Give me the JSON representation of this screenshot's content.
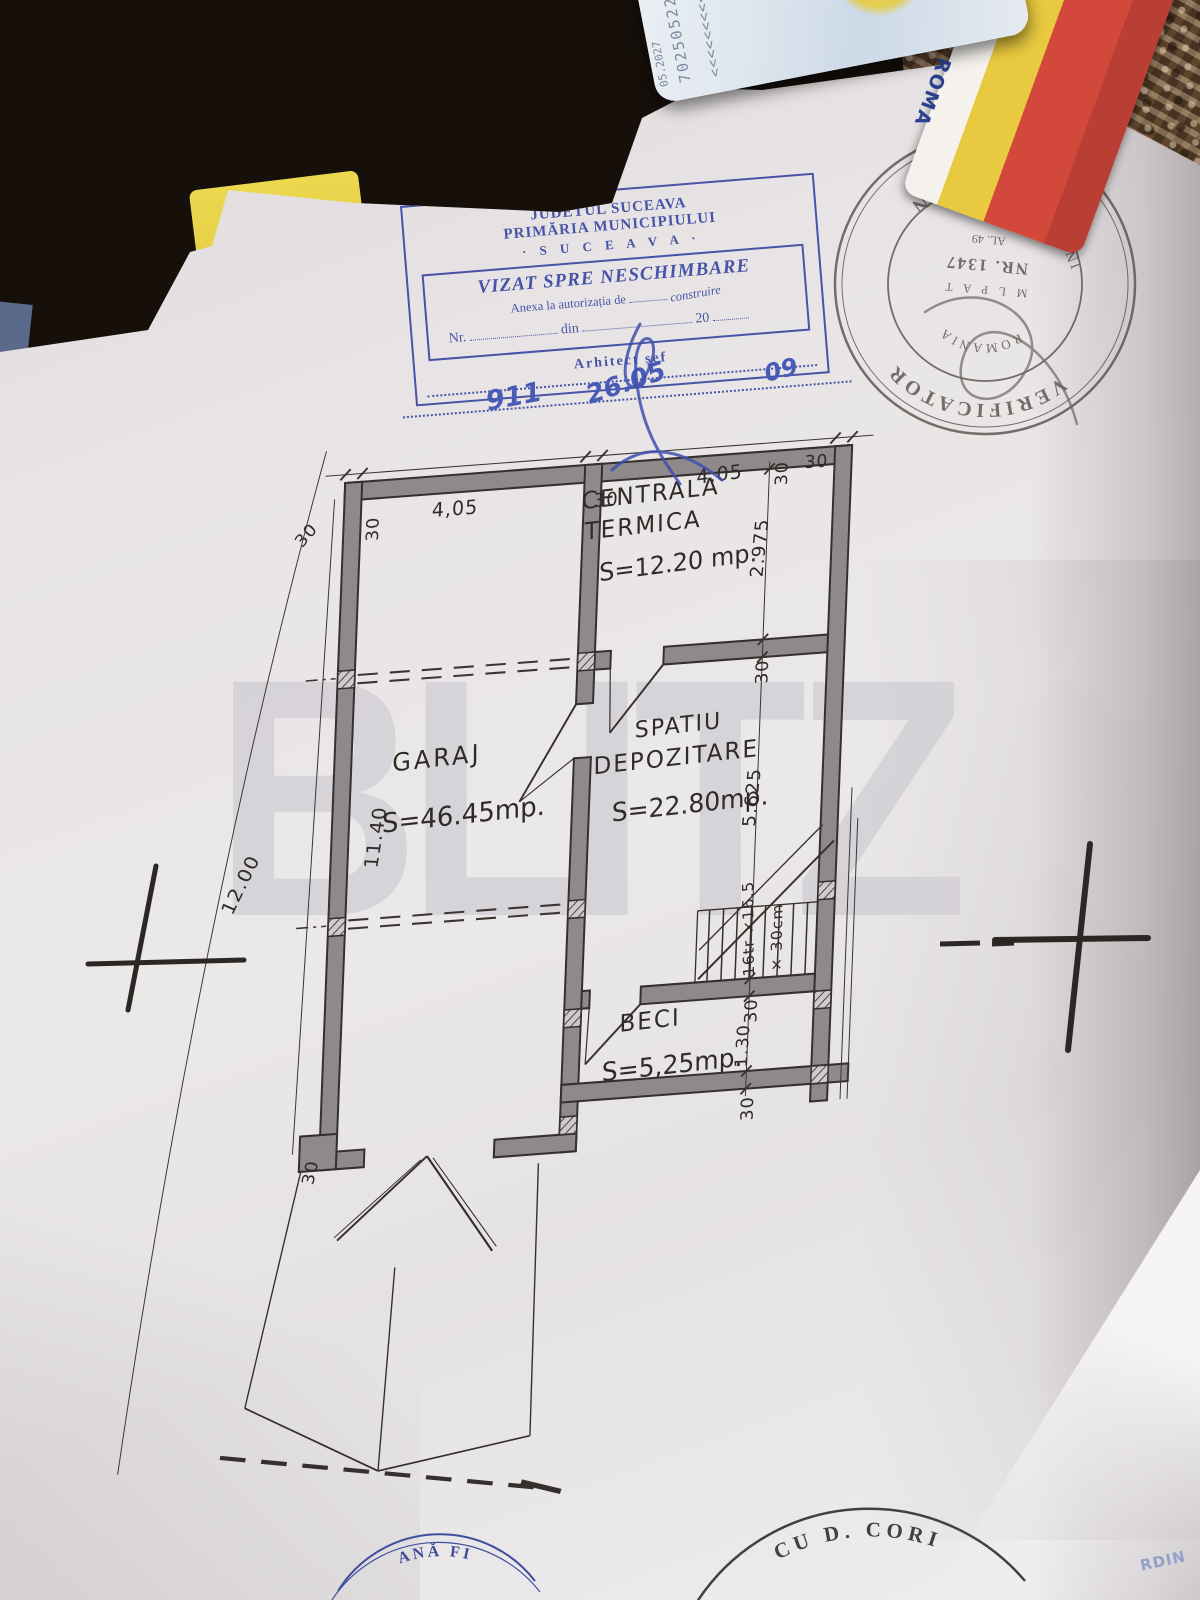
{
  "watermark": "BLITZ",
  "approval_stamp": {
    "county": "JUDETUL SUCEAVA",
    "municipality": "PRIMĂRIA MUNICIPIULUI",
    "city": "· S U C E A V A ·",
    "title": "VIZAT SPRE NESCHIMBARE",
    "annex_prefix": "Anexa la autorizația de",
    "annex_value": "construire",
    "nr_label": "Nr.",
    "din_label": "din",
    "year_prefix": "20",
    "signer": "Arhitect șef",
    "hand_nr": "911",
    "hand_date": "26.05",
    "hand_year": "09"
  },
  "verifier_stamp": {
    "ring_top": "VERIFICATOR",
    "ring_side1": "INGINER",
    "ring_side2": "PROIECTE",
    "ring_bottom": "GHITA D. IOAN",
    "country": "ROMANIA",
    "org": "M L P A T",
    "number": "NR. 1347",
    "al": "AL. 49"
  },
  "plan": {
    "rooms": {
      "centrala": {
        "name1": "CENTRALA",
        "name2": "TERMICA",
        "area": "S=12.20 mp."
      },
      "garaj": {
        "name": "GARAJ",
        "area": "S=46.45mp."
      },
      "depozitare": {
        "name1": "SPATIU",
        "name2": "DEPOZITARE",
        "area": "S=22.80mp."
      },
      "beci": {
        "name": "BECI",
        "area": "S=5,25mp."
      }
    },
    "stair_note1": "16tr ×16.5",
    "stair_note2": "× 30cm",
    "dims": {
      "wall": "30",
      "top_left_span": "4,05",
      "top_right_span": "4.05",
      "h_centrala": "2.975",
      "h_depozitare": "5.625",
      "h_beci": "1.30",
      "left_inner": "11.40",
      "left_outer": "12.00"
    }
  },
  "bottom_stamps": {
    "left": "ANĂ FI",
    "center": "CU D. CORI",
    "right": "RDIN"
  },
  "id_card": {
    "country": "ROMA",
    "serial": "7025052204",
    "mrz": "<<<<<<<<<<<<",
    "date": "05.2027"
  }
}
